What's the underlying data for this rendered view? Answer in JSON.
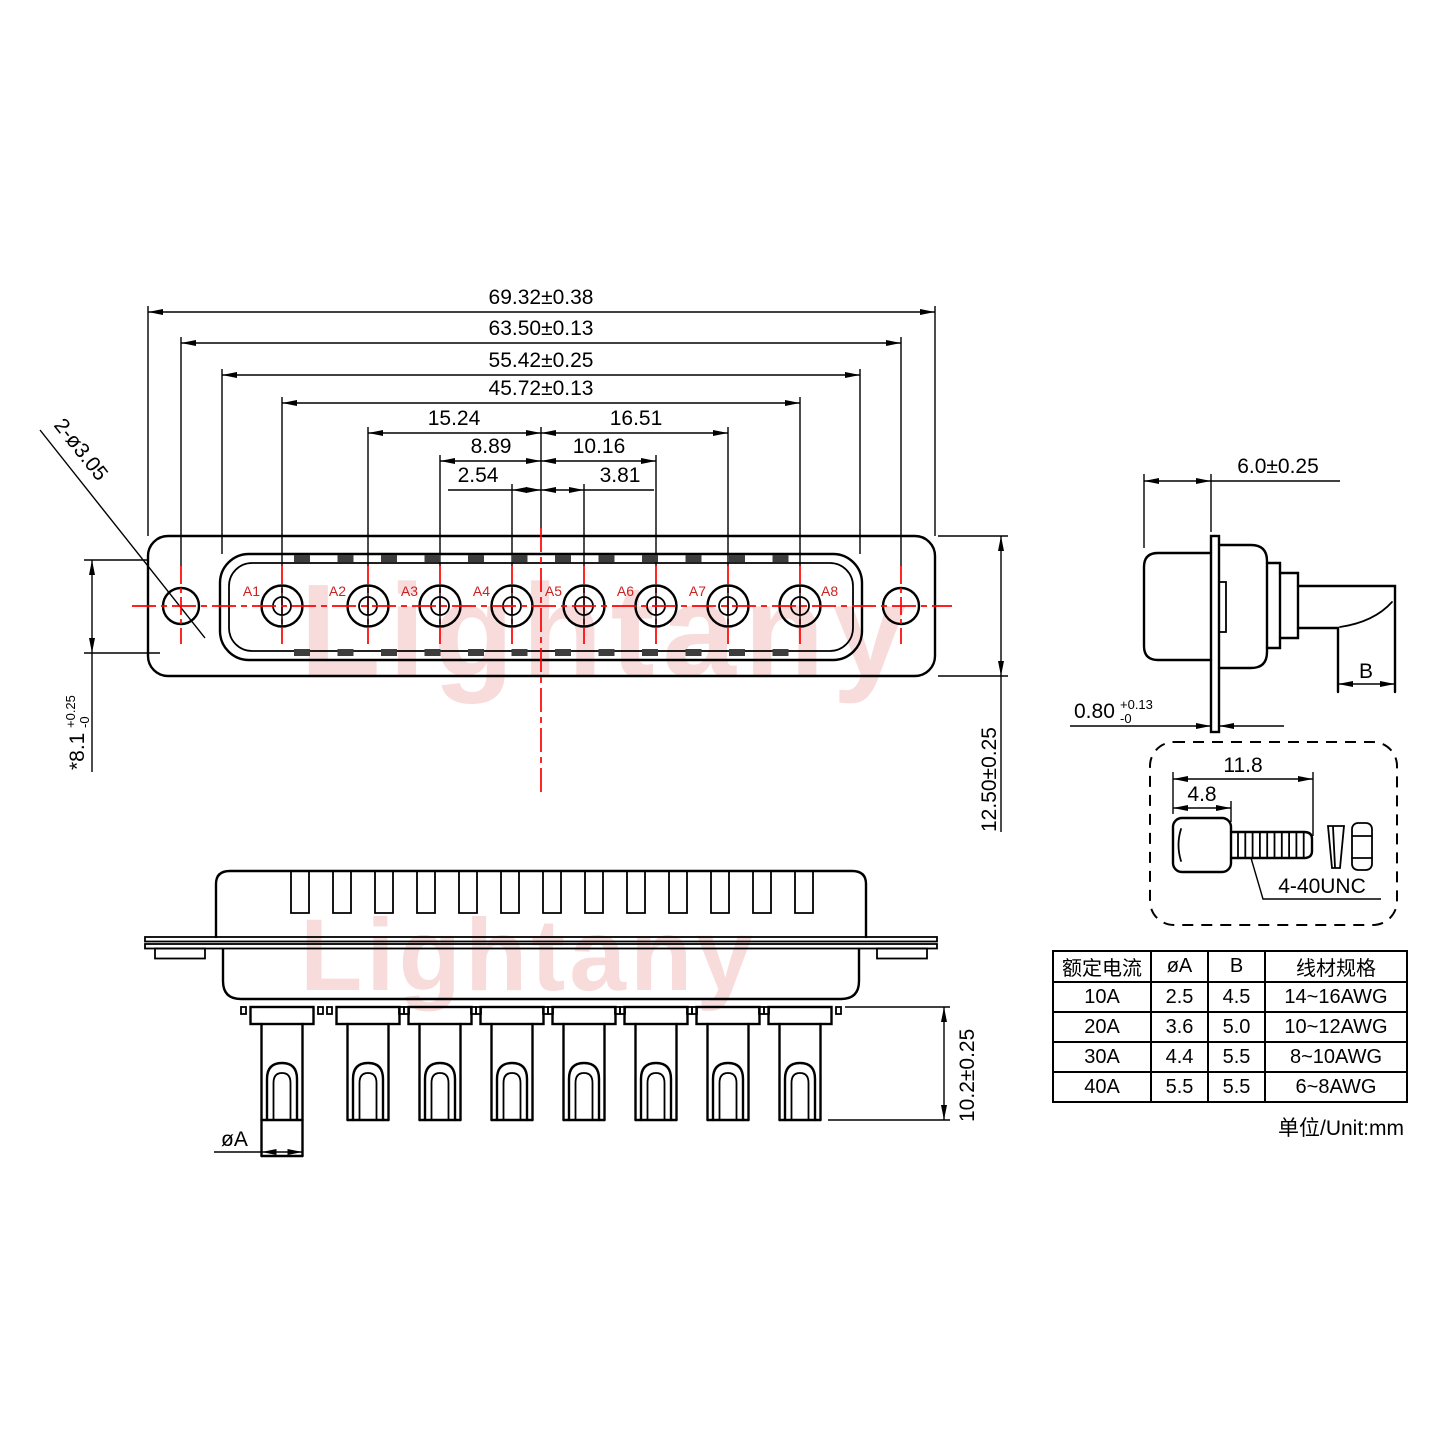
{
  "watermark": {
    "text": "Lightany",
    "color": "#e05252"
  },
  "colors": {
    "line": "#000000",
    "centerline": "#ff0000",
    "pin_label": "#cc2222"
  },
  "front_view": {
    "pin_labels": [
      "A1",
      "A2",
      "A3",
      "A4",
      "A5",
      "A6",
      "A7",
      "A8"
    ],
    "dims": {
      "overall_width": "69.32±0.38",
      "hole_span": "63.50±0.13",
      "shell_width": "55.42±0.25",
      "pin_span": "45.72±0.13",
      "center_to_a2": "15.24",
      "center_to_a7": "16.51",
      "center_to_a3": "8.89",
      "center_to_a6": "10.16",
      "center_to_a4": "2.54",
      "center_to_a5": "3.81",
      "mount_hole_note": "2-ø3.05",
      "body_height": "12.50±0.25",
      "shell_opening": {
        "main": "*8.1",
        "tol_up": "+0.25",
        "tol_dn": "-0"
      }
    }
  },
  "side_view": {
    "dims": {
      "front_depth": "6.0±0.25",
      "flange_thickness": {
        "main": "0.80",
        "tol_up": "+0.13",
        "tol_dn": "-0"
      },
      "terminal_width": "B"
    }
  },
  "screw_detail": {
    "dims": {
      "overall_length": "11.8",
      "head_length": "4.8"
    },
    "thread_spec": "4-40UNC"
  },
  "bottom_view": {
    "dims": {
      "pin_length": "10.2±0.25",
      "pin_diameter": "øA"
    }
  },
  "spec_table": {
    "headers": [
      "额定电流",
      "øA",
      "B",
      "线材规格"
    ],
    "rows": [
      [
        "10A",
        "2.5",
        "4.5",
        "14~16AWG"
      ],
      [
        "20A",
        "3.6",
        "5.0",
        "10~12AWG"
      ],
      [
        "30A",
        "4.4",
        "5.5",
        "8~10AWG"
      ],
      [
        "40A",
        "5.5",
        "5.5",
        "6~8AWG"
      ]
    ],
    "unit_note": "单位/Unit:mm"
  }
}
